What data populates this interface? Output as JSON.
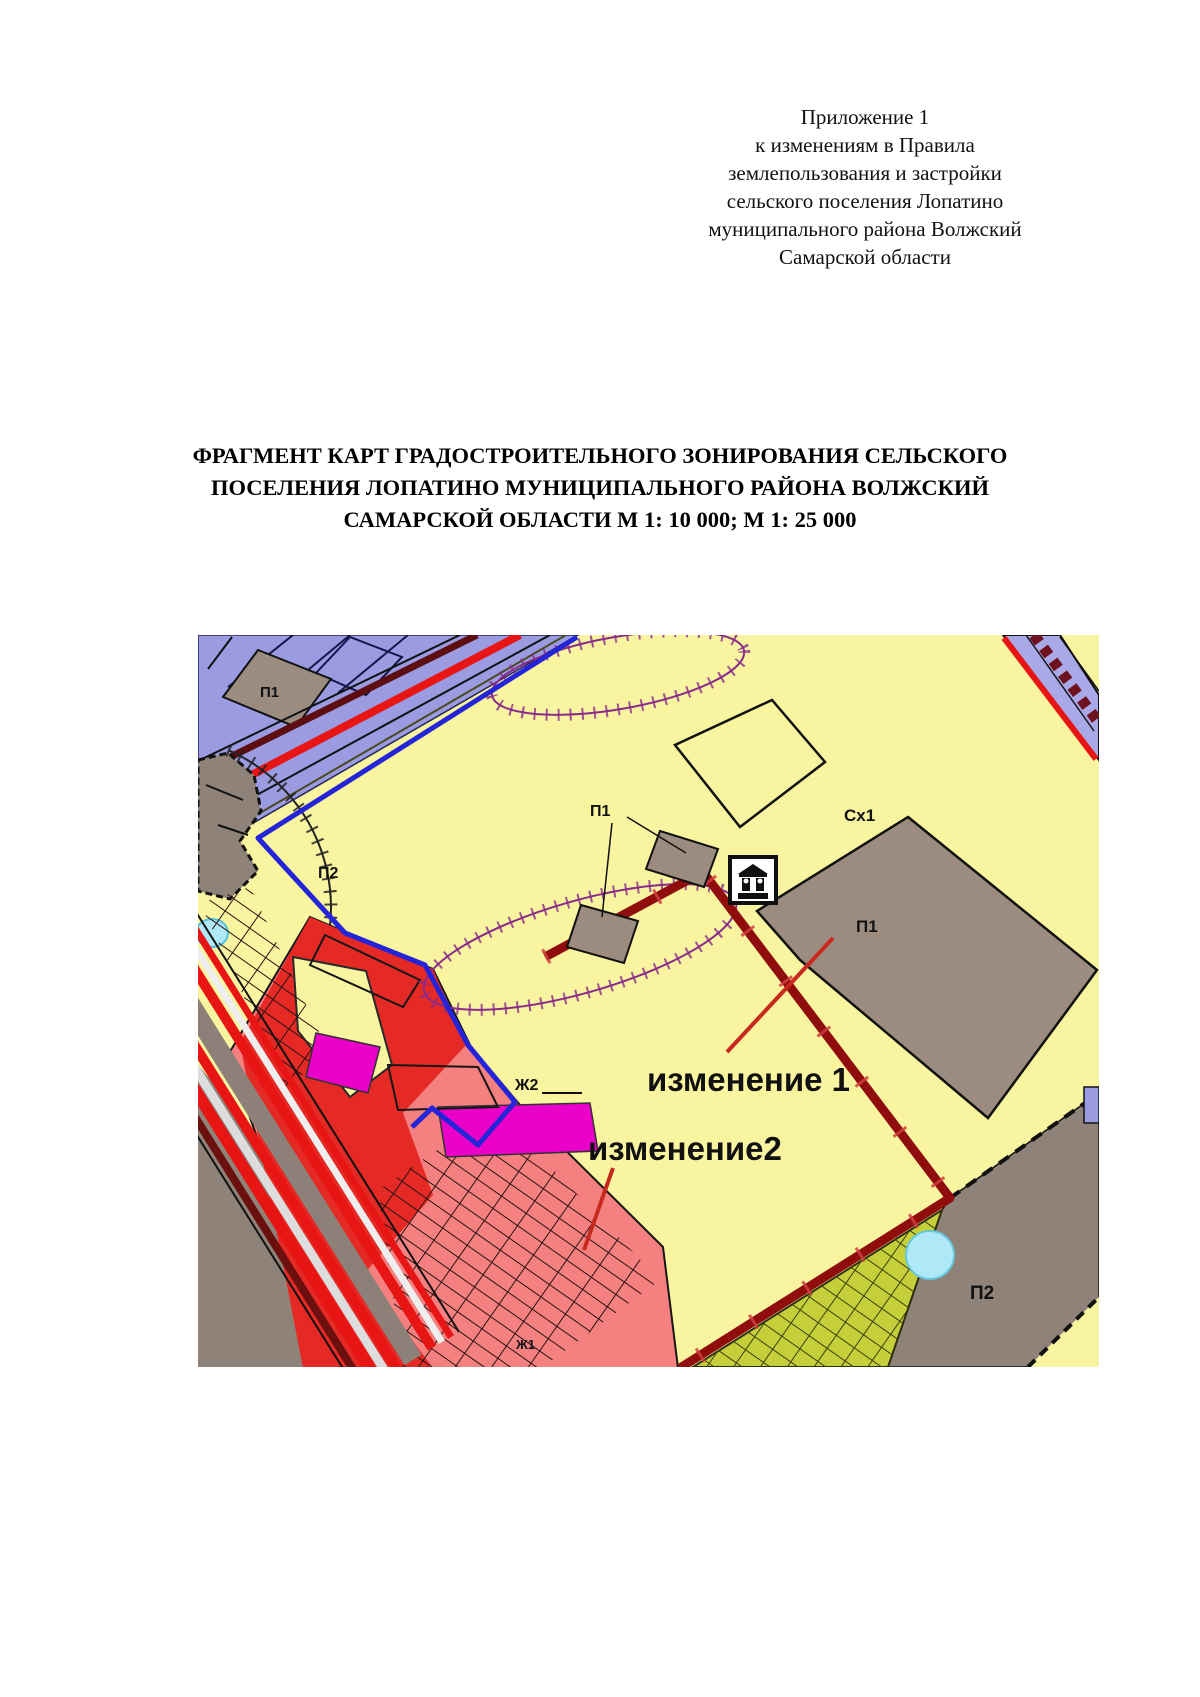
{
  "document": {
    "header_lines": [
      "Приложение 1",
      "к изменениям в Правила",
      "землепользования и застройки",
      "сельского поселения Лопатино",
      "муниципального района Волжский",
      "Самарской области"
    ],
    "title_lines": [
      "ФРАГМЕНТ КАРТ ГРАДОСТРОИТЕЛЬНОГО ЗОНИРОВАНИЯ СЕЛЬСКОГО",
      "ПОСЕЛЕНИЯ ЛОПАТИНО МУНИЦИПАЛЬНОГО РАЙОНА ВОЛЖСКИЙ",
      "САМАРСКОЙ ОБЛАСТИ М 1: 10 000; М 1: 25 000"
    ]
  },
  "map": {
    "labels": {
      "zone_p1_nw": "П1",
      "zone_p2_arc": "П2",
      "zone_p1_pair": "П1",
      "zone_cx1": "Сх1",
      "zone_p1_large": "П1",
      "zone_zh2": "Ж2",
      "zone_zh1": "Ж1",
      "zone_p2_se": "П2"
    },
    "annotations": {
      "change1": "изменение 1",
      "change2": "изменение2"
    },
    "icons": {
      "monument": "landmark-icon"
    },
    "colors": {
      "background": "#F8F4A0",
      "zone_violet": "#9B9BE2",
      "zone_brown": "#9C8C80",
      "zone_grey": "#8F8278",
      "zone_red_light": "#F58080",
      "zone_red_bright": "#E52A25",
      "zone_magenta": "#EA00C8",
      "zone_green": "#C5CF3A",
      "water": "#AFE9F7",
      "road_red": "#E81515",
      "boundary_blue": "#2424D8",
      "boundary_maroon": "#8F0D0D",
      "change_red": "#C8291F",
      "hatch_purple": "#8A2B8A"
    }
  }
}
